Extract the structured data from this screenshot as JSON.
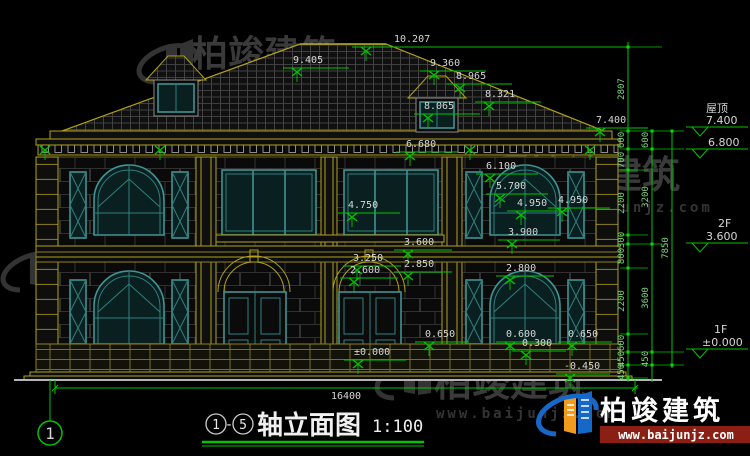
{
  "brand": {
    "name": "柏竣建筑",
    "url": "www.baijunjz.com"
  },
  "title": {
    "c1": "1",
    "dash": "-",
    "c2": "5",
    "text": "轴立面图",
    "scale": "1:100"
  },
  "footer": {
    "total": "16400",
    "axis": "1"
  },
  "dims": {
    "ridge": "10.207",
    "roof_l": "9.405",
    "roof_r1": "9.360",
    "roof_r2": "8.965",
    "roof_r3": "8.321",
    "roof_r4": "8.065",
    "eave": "7.400",
    "cornice": "6.680",
    "win2f_head": "6.100",
    "win2f_arch": "5.700",
    "wing_cap_a": "4.950",
    "wing_cap_b": "4.950",
    "porch2f": "4.750",
    "win2f_sill": "3.900",
    "band_top": "3.600",
    "arch_l_top": "3.250",
    "arch_r": "2.850",
    "arch_l": "2.600",
    "win1f_head": "2.800",
    "plinth_l": "0.650",
    "plinth_m": "0.600",
    "plinth_s": "0.300",
    "plinth_r": "0.650",
    "ground": "-0.450",
    "floor": "±0.000"
  },
  "chains": {
    "c1": [
      "2807",
      "600",
      "700",
      "2200",
      "300",
      "800",
      "2200",
      "600",
      "450",
      "450"
    ],
    "c2": [
      "600",
      "3200",
      "3600",
      "450"
    ],
    "c3": [
      "7850"
    ]
  },
  "levels": {
    "roof_name": "屋顶",
    "roof_val": "7.400",
    "mid_val": "6.800",
    "f2_name": "2F",
    "f2_val": "3.600",
    "f1_name": "1F",
    "f1_val": "±0.000"
  }
}
